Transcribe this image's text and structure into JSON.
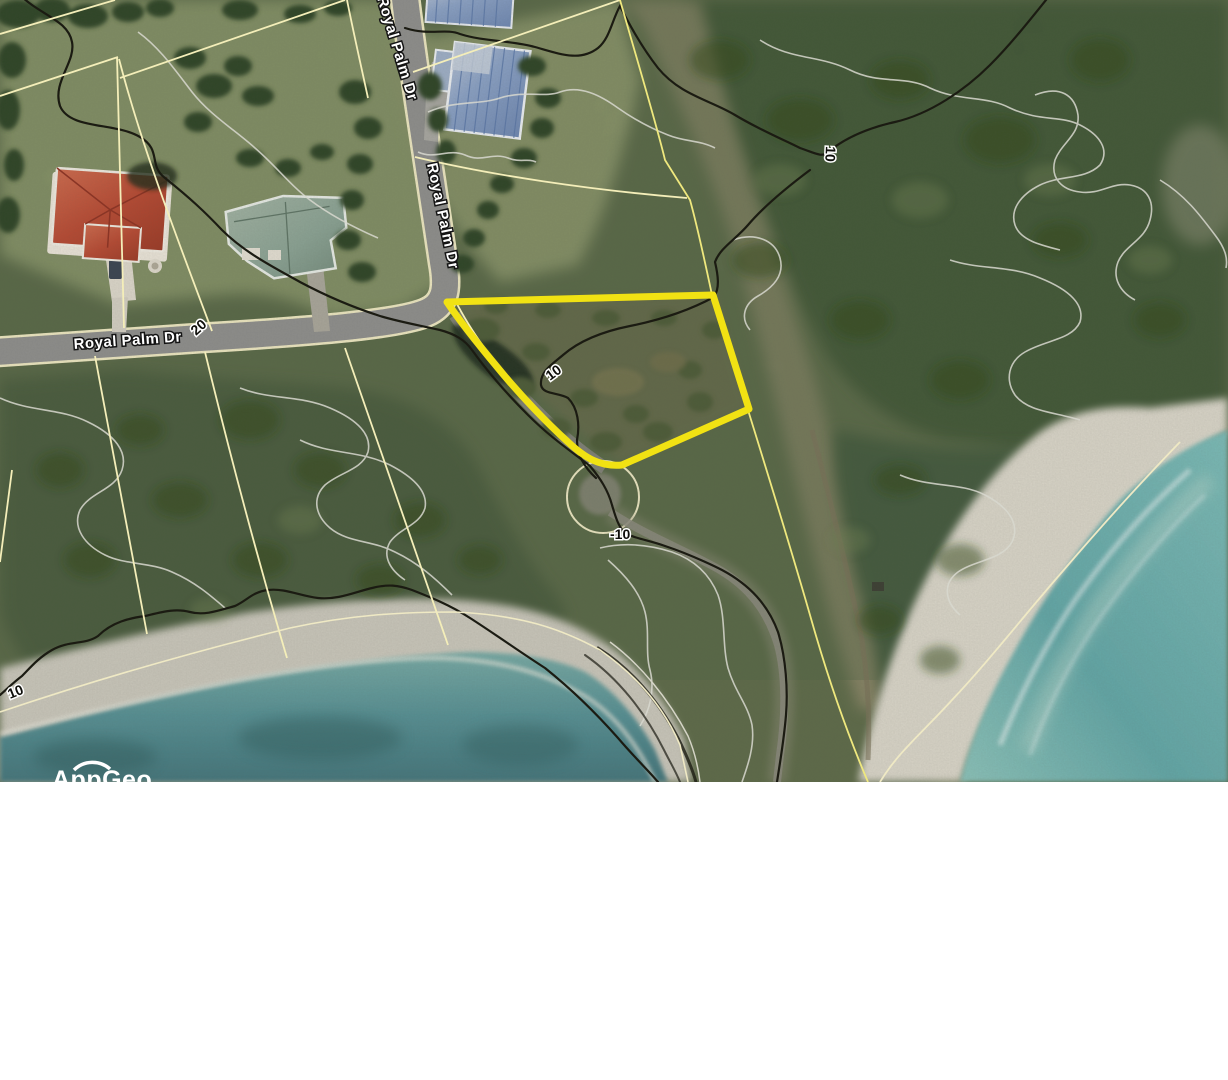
{
  "map": {
    "street_labels": [
      {
        "id": "royal-palm-dr-north",
        "text": "Royal Palm Dr"
      },
      {
        "id": "royal-palm-dr-mid",
        "text": "Royal Palm Dr"
      },
      {
        "id": "royal-palm-dr-west",
        "text": "Royal Palm Dr"
      }
    ],
    "contour_labels": [
      {
        "id": "contour-20-road",
        "text": "20"
      },
      {
        "id": "contour-10-northeast",
        "text": "10"
      },
      {
        "id": "contour-10-parcel",
        "text": "10"
      },
      {
        "id": "contour-10-culdesac",
        "text": "-10"
      },
      {
        "id": "contour-10-beach",
        "text": "10"
      }
    ],
    "watermark": {
      "text": "AppGeo"
    },
    "colors": {
      "parcel_highlight": "#f1e213",
      "parcel_line": "#f4eeb9",
      "contour_major": "#1b1b12",
      "contour_minor": "#d8d8cf",
      "road": "#8f8f8d",
      "water_deep": "#44767c",
      "water_shallow": "#7fb7b3",
      "sand": "#d6d2c6",
      "forest": "#3c5233",
      "scrub": "#5e6b49",
      "roof_red": "#b84a33",
      "roof_teal": "#8ba394",
      "roof_blue": "#7e96bd"
    }
  }
}
